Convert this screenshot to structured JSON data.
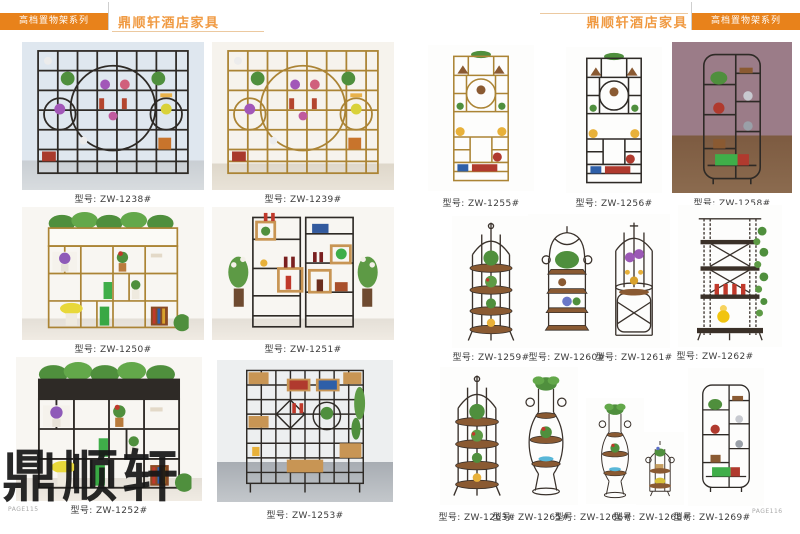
{
  "header": {
    "left": {
      "series": "高档置物架系列",
      "brand": "鼎顺轩酒店家具"
    },
    "right": {
      "series": "高档置物架系列",
      "brand": "鼎顺轩酒店家具"
    }
  },
  "watermark": "鼎顺轩",
  "page_numbers": {
    "left": "PAGE115",
    "right": "PAGE116"
  },
  "model_prefix": "型号:",
  "products": [
    {
      "model": "ZW-1238#",
      "label": "型号: ZW-1238#",
      "frame_color": "#2e2a26",
      "type": "screen-display-shelf"
    },
    {
      "model": "ZW-1239#",
      "label": "型号: ZW-1239#",
      "frame_color": "#ab8435",
      "type": "screen-display-shelf"
    },
    {
      "model": "ZW-1250#",
      "label": "型号: ZW-1250#",
      "frame_color": "#ab8435",
      "type": "planter-top-shelf"
    },
    {
      "model": "ZW-1251#",
      "label": "型号: ZW-1251#",
      "frame_color": "#2e2a26",
      "type": "double-bay-shelf"
    },
    {
      "model": "ZW-1252#",
      "label": "型号: ZW-1252#",
      "frame_color": "#2e2a26",
      "type": "planter-top-shelf"
    },
    {
      "model": "ZW-1253#",
      "label": "型号: ZW-1253#",
      "frame_color": "#2e2a26",
      "type": "grid-display-shelf"
    },
    {
      "model": "ZW-1255#",
      "label": "型号: ZW-1255#",
      "frame_color": "#ab8435",
      "type": "tall-display-shelf"
    },
    {
      "model": "ZW-1256#",
      "label": "型号: ZW-1256#",
      "frame_color": "#2e2a26",
      "type": "tall-display-shelf"
    },
    {
      "model": "ZW-1258#",
      "label": "型号: ZW-1258#",
      "frame_color": "#2e2a26",
      "type": "roundtop-display-shelf"
    },
    {
      "model": "ZW-1259#",
      "label": "型号: ZW-1259#",
      "frame_color": "#3a322c",
      "type": "birdcage-plant-stand"
    },
    {
      "model": "ZW-1260#",
      "label": "型号: ZW-1260#",
      "frame_color": "#3a322c",
      "type": "arch-plant-stand"
    },
    {
      "model": "ZW-1261#",
      "label": "型号: ZW-1261#",
      "frame_color": "#3a322c",
      "type": "cylinder-cage-stand"
    },
    {
      "model": "ZW-1262#",
      "label": "型号: ZW-1262#",
      "frame_color": "#3a322c",
      "type": "chain-ladder-shelf"
    },
    {
      "model": "ZW-1263#",
      "label": "型号: ZW-1263#",
      "frame_color": "#3a322c",
      "type": "birdcage-plant-stand"
    },
    {
      "model": "ZW-1265#",
      "label": "型号: ZW-1265#",
      "frame_color": "#3a322c",
      "type": "vase-plant-stand"
    },
    {
      "model": "ZW-1266#",
      "label": "型号: ZW-1266#",
      "frame_color": "#3a322c",
      "type": "vase-plant-stand"
    },
    {
      "model": "ZW-1268#",
      "label": "型号: ZW-1268#",
      "frame_color": "#3a322c",
      "type": "small-birdcage-stand"
    },
    {
      "model": "ZW-1269#",
      "label": "型号: ZW-1269#",
      "frame_color": "#2e2a26",
      "type": "roundtop-display-shelf"
    }
  ]
}
